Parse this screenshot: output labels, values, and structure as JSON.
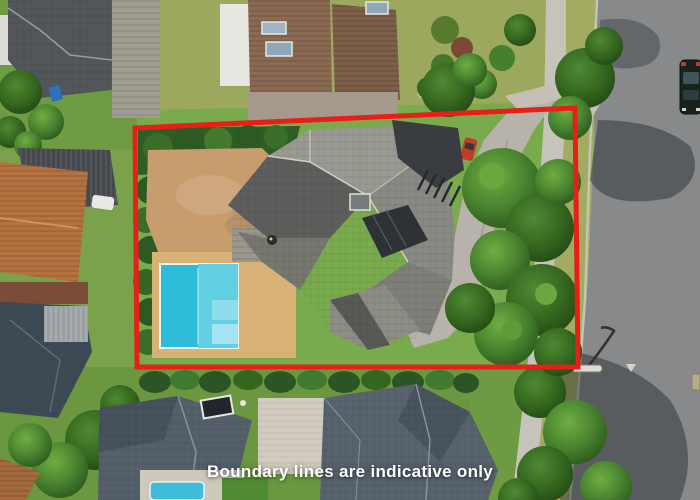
{
  "overlay": {
    "disclaimer": "Boundary lines are indicative only",
    "text_color": "#ffffff"
  },
  "boundary": {
    "color": "#e62019",
    "stroke_width": "5",
    "points": "135,128 575,108 578,367 137,367"
  },
  "palette": {
    "lawn_green": "#7aa24b",
    "olive_lawn": "#9ca85d",
    "road_gray": "#87898b",
    "footpath_gray": "#c6c3ba",
    "driveway_gray": "#b7b3aa",
    "main_roof_gray": "#9a9a93",
    "neighbor_roof_blue_gray": "#55606b",
    "terracotta_roof": "#b5713f",
    "brown_tile_roof": "#8a6a52",
    "pool_blue": "#2fbcd9",
    "pool_deck_tan": "#d9b275",
    "paving_tan": "#c79d6e",
    "tree_green": "#3f7a2c",
    "hedge_dark_green": "#2e5a26"
  }
}
